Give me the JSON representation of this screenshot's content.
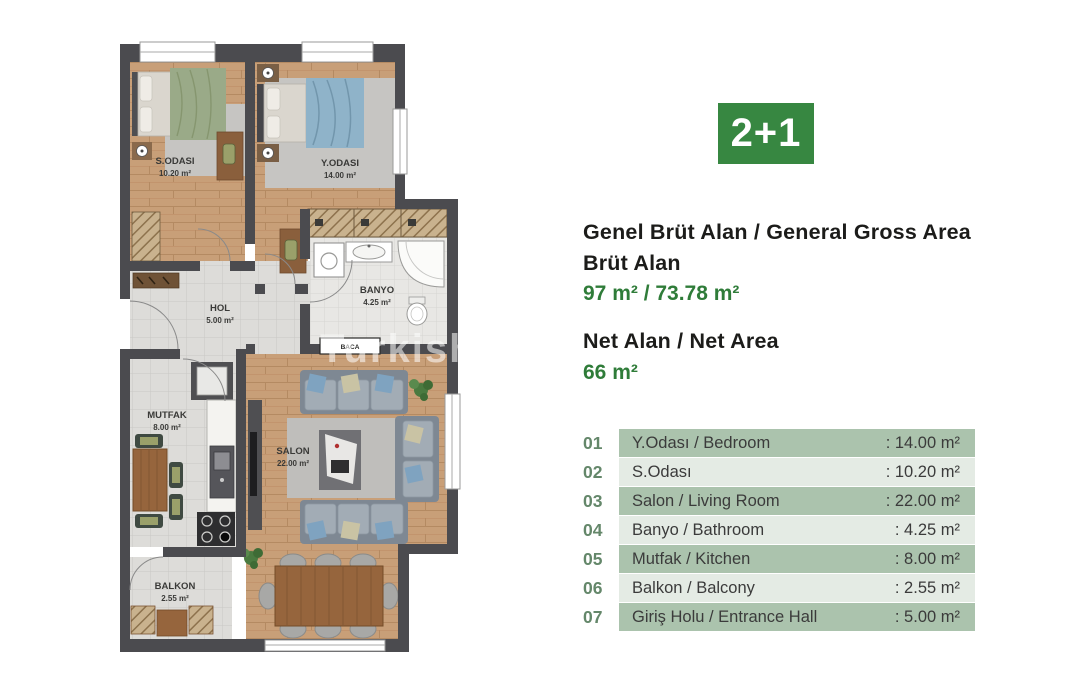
{
  "badge": {
    "label": "2+1",
    "color": "#378741"
  },
  "summary": {
    "gross_title": "Genel Brüt Alan / General Gross Area",
    "gross_subtitle": "Brüt Alan",
    "gross_value": "97 m² / 73.78 m²",
    "net_title": "Net Alan / Net Area",
    "net_value": "66 m²",
    "value_color": "#2f7c39"
  },
  "room_table": {
    "row_dark_color": "#abc3ad",
    "row_light_color": "#e4ebe4",
    "number_color": "#64876a",
    "rows": [
      {
        "num": "01",
        "label": "Y.Odası / Bedroom",
        "value": ": 14.00 m²"
      },
      {
        "num": "02",
        "label": "S.Odası",
        "value": ": 10.20 m²"
      },
      {
        "num": "03",
        "label": "Salon / Living Room",
        "value": ": 22.00 m²"
      },
      {
        "num": "04",
        "label": "Banyo / Bathroom",
        "value": ": 4.25 m²"
      },
      {
        "num": "05",
        "label": "Mutfak / Kitchen",
        "value": ": 8.00 m²"
      },
      {
        "num": "06",
        "label": "Balkon / Balcony",
        "value": ": 2.55 m²"
      },
      {
        "num": "07",
        "label": "Giriş Holu / Entrance Hall",
        "value": ": 5.00 m²"
      }
    ]
  },
  "floor_plan": {
    "wall_color": "#4b4b4f",
    "rooms": {
      "s_odasi": {
        "name": "S.ODASI",
        "area": "10.20 m²"
      },
      "y_odasi": {
        "name": "Y.ODASI",
        "area": "14.00 m²"
      },
      "banyo": {
        "name": "BANYO",
        "area": "4.25 m²"
      },
      "hol": {
        "name": "HOL",
        "area": "5.00 m²"
      },
      "mutfak": {
        "name": "MUTFAK",
        "area": "8.00 m²"
      },
      "salon": {
        "name": "SALON",
        "area": "22.00 m²"
      },
      "balkon": {
        "name": "BALKON",
        "area": "2.55 m²"
      }
    },
    "baca_label": "BACA",
    "watermark": "Turkish"
  }
}
